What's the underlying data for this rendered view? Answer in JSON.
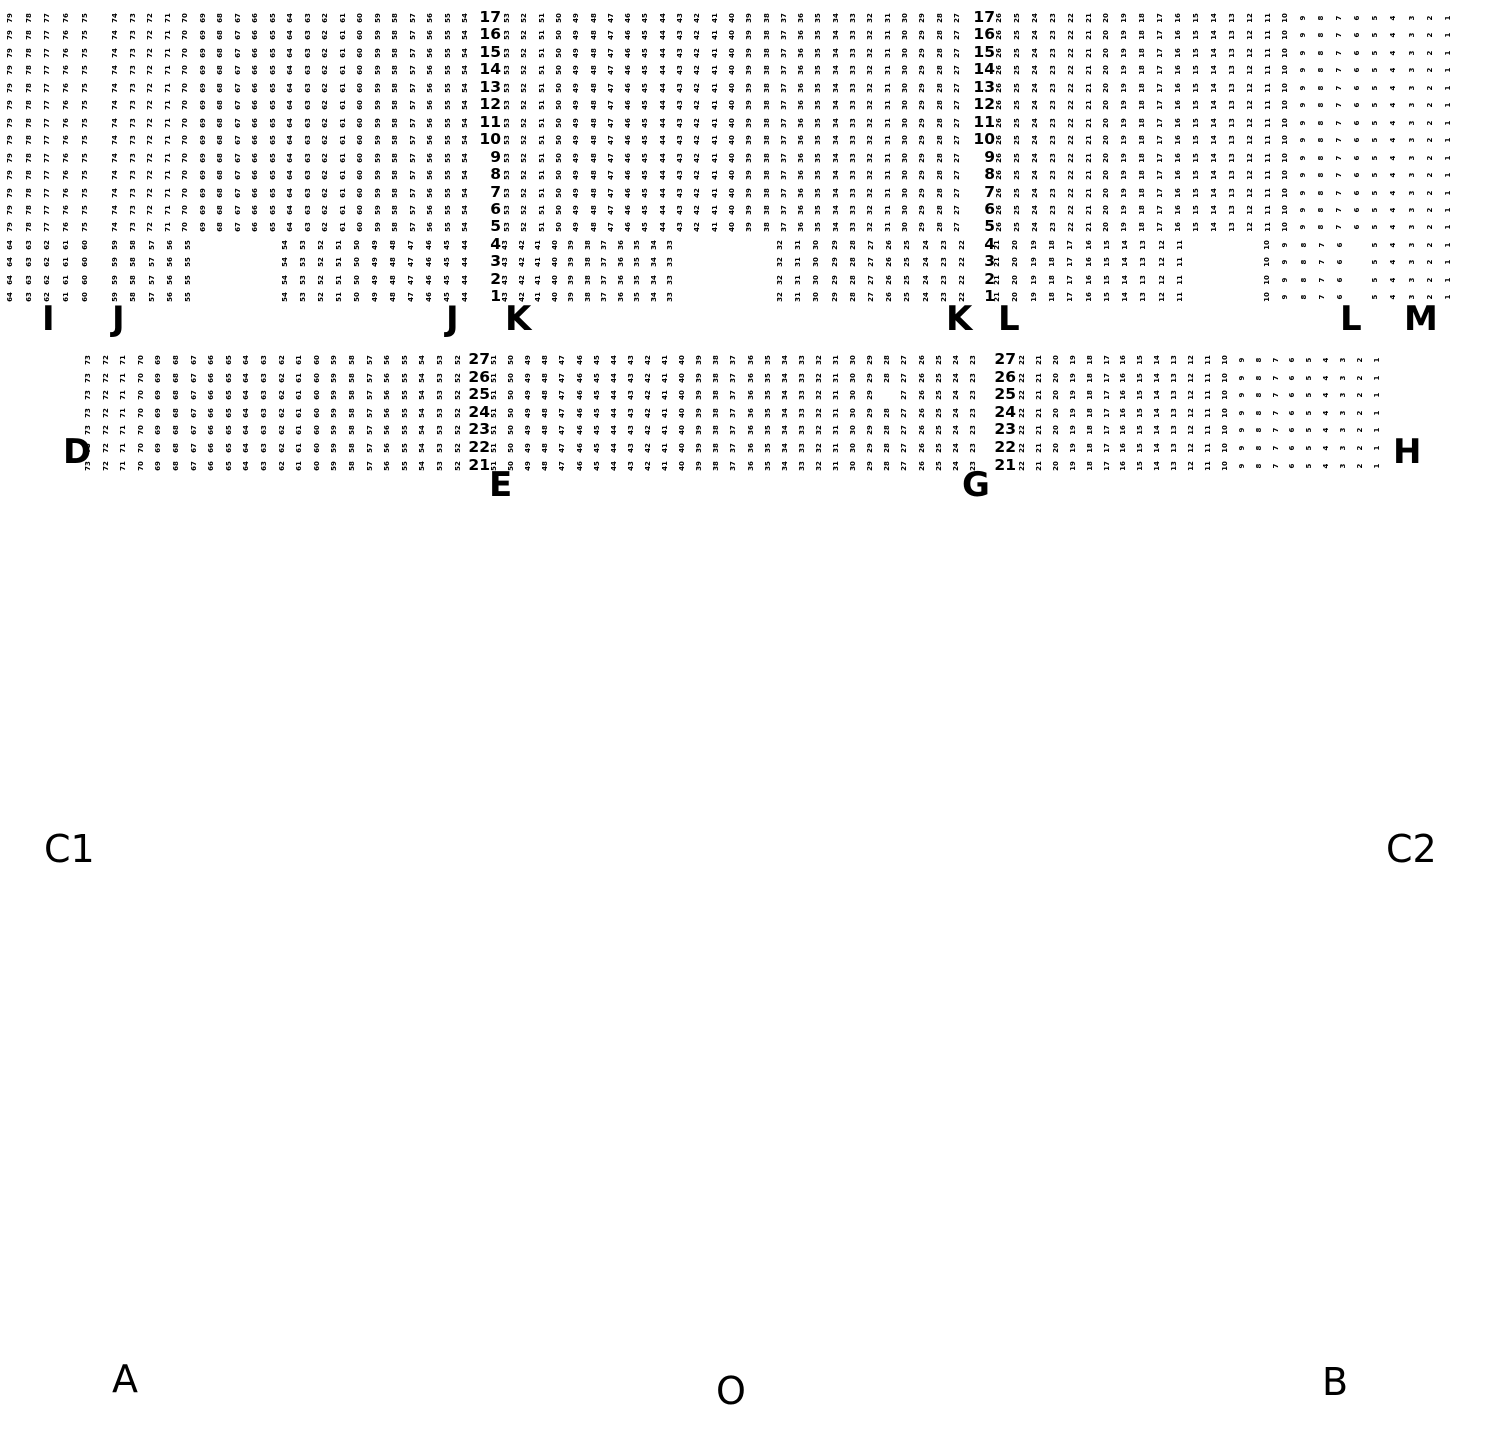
{
  "page": {
    "background": "#ffffff",
    "text_color": "#000000",
    "width": 1490,
    "height": 1430,
    "description_of_visible_content": "venue seating map with numbered seat grid, two balcony tiers and floor section labels"
  },
  "seat_map": {
    "seat_color": "#000000",
    "tiers": [
      {
        "name": "upper-balcony",
        "row_min": 1,
        "row_max": 17,
        "y_top": 10,
        "row_pitch": 17.45,
        "label_columns": [
          {
            "right_x": 501
          },
          {
            "right_x": 995
          }
        ],
        "blocks": [
          {
            "section": "I",
            "row_min": 5,
            "row_max": 17,
            "seat_left": 79,
            "seat_right": 75,
            "x_start": 10,
            "pitch": 18.7
          },
          {
            "section": "I",
            "row_min": 1,
            "row_max": 4,
            "seat_left": 64,
            "seat_right": 60,
            "x_start": 10,
            "pitch": 18.7
          },
          {
            "section": "J",
            "row_min": 5,
            "row_max": 17,
            "seat_left": 74,
            "seat_right": 54,
            "x_start": 115,
            "pitch": 17.5
          },
          {
            "section": "J",
            "row_min": 1,
            "row_max": 4,
            "seat_left": 59,
            "seat_right": 55,
            "x_start": 115,
            "pitch": 18.3
          },
          {
            "section": "J",
            "row_min": 1,
            "row_max": 4,
            "seat_left": 54,
            "seat_right": 44,
            "x_start": 285,
            "pitch": 18.0
          },
          {
            "section": "K",
            "row_min": 5,
            "row_max": 17,
            "seat_left": 53,
            "seat_right": 27,
            "x_start": 507,
            "pitch": 17.3
          },
          {
            "section": "K",
            "row_min": 1,
            "row_max": 4,
            "seat_left": 43,
            "seat_right": 33,
            "x_start": 505,
            "pitch": 16.5
          },
          {
            "section": "K",
            "row_min": 1,
            "row_max": 4,
            "seat_left": 32,
            "seat_right": 22,
            "x_start": 780,
            "pitch": 18.2
          },
          {
            "section": "L",
            "row_min": 5,
            "row_max": 17,
            "seat_left": 26,
            "seat_right": 6,
            "x_start": 999,
            "pitch": 17.9
          },
          {
            "section": "L",
            "row_min": 1,
            "row_max": 4,
            "seat_left": 21,
            "seat_right": 11,
            "x_start": 997,
            "pitch": 18.3
          },
          {
            "section": "L",
            "row_min": 1,
            "row_max": 4,
            "seat_left": 10,
            "seat_right": 6,
            "x_start": 1267,
            "pitch": 18.3
          },
          {
            "section": "M",
            "row_min": 1,
            "row_max": 17,
            "seat_left": 5,
            "seat_right": 1,
            "x_start": 1375,
            "pitch": 18.3
          }
        ]
      },
      {
        "name": "lower-balcony",
        "row_min": 21,
        "row_max": 27,
        "y_top": 352,
        "row_pitch": 17.6,
        "label_columns": [
          {
            "right_x": 490
          },
          {
            "right_x": 1016
          }
        ],
        "blocks": [
          {
            "section": "D",
            "row_min": 21,
            "row_max": 27,
            "seat_left": 73,
            "seat_right": 52,
            "x_start": 88,
            "pitch": 17.6
          },
          {
            "section": "E",
            "row_min": 21,
            "row_max": 27,
            "seat_left": 51,
            "seat_right": 23,
            "x_start": 494,
            "pitch": 17.1,
            "missing": [
              {
                "row": 25,
                "seat": 28
              }
            ]
          },
          {
            "section": "G",
            "row_min": 21,
            "row_max": 27,
            "seat_left": 22,
            "seat_right": 1,
            "x_start": 1022,
            "pitch": 16.9
          }
        ]
      }
    ],
    "section_labels": [
      {
        "text": "I",
        "x": 42,
        "y": 300,
        "bold": true
      },
      {
        "text": "J",
        "x": 112,
        "y": 300,
        "bold": true
      },
      {
        "text": "J",
        "x": 446,
        "y": 300,
        "bold": true
      },
      {
        "text": "K",
        "x": 505,
        "y": 300,
        "bold": true
      },
      {
        "text": "K",
        "x": 946,
        "y": 300,
        "bold": true
      },
      {
        "text": "L",
        "x": 998,
        "y": 300,
        "bold": true
      },
      {
        "text": "L",
        "x": 1340,
        "y": 300,
        "bold": true
      },
      {
        "text": "M",
        "x": 1404,
        "y": 300,
        "bold": true
      },
      {
        "text": "D",
        "x": 63,
        "y": 433,
        "bold": true
      },
      {
        "text": "E",
        "x": 489,
        "y": 466,
        "bold": true
      },
      {
        "text": "G",
        "x": 962,
        "y": 466,
        "bold": true
      },
      {
        "text": "H",
        "x": 1393,
        "y": 433,
        "bold": true
      },
      {
        "text": "C1",
        "x": 44,
        "y": 827,
        "bold": false
      },
      {
        "text": "C2",
        "x": 1386,
        "y": 827,
        "bold": false
      },
      {
        "text": "A",
        "x": 112,
        "y": 1357,
        "bold": false
      },
      {
        "text": "B",
        "x": 1322,
        "y": 1360,
        "bold": false
      },
      {
        "text": "O",
        "x": 716,
        "y": 1369,
        "bold": false
      }
    ]
  }
}
